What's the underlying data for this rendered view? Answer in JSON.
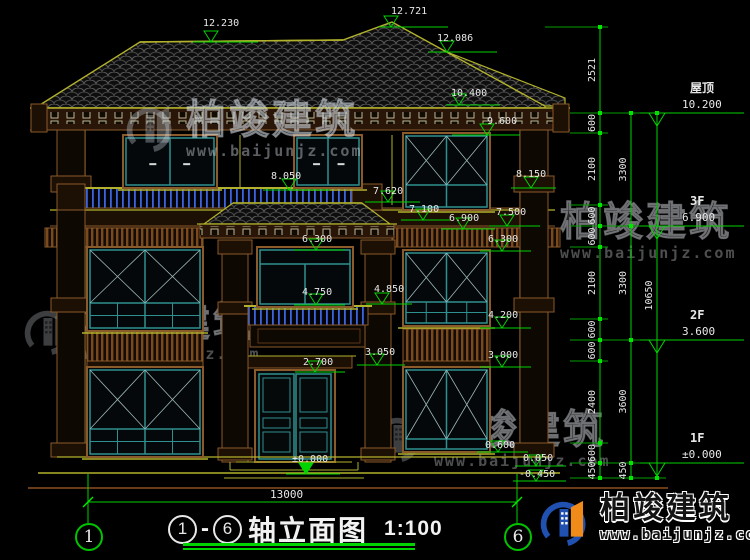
{
  "drawing": {
    "axis_left": "1",
    "axis_right": "6",
    "separator": "-",
    "title_text": "轴立面图",
    "scale": "1:100",
    "overall_dim": "13000"
  },
  "brand": {
    "name": "柏竣建筑",
    "url": "www.baijunjz.com"
  },
  "right_panel": {
    "flags": [
      {
        "name": "屋顶",
        "elev": "10.200",
        "y": 113
      },
      {
        "name": "3F",
        "elev": "6.900",
        "y": 226
      },
      {
        "name": "2F",
        "elev": "3.600",
        "y": 340
      },
      {
        "name": "1F",
        "elev": "±0.000",
        "y": 463
      }
    ],
    "col1": {
      "x": 600,
      "segs": [
        [
          "2521",
          27,
          113
        ],
        [
          "600",
          113,
          133
        ],
        [
          "2100",
          133,
          205
        ],
        [
          "600",
          205,
          226
        ],
        [
          "600",
          226,
          247
        ],
        [
          "2100",
          247,
          319
        ],
        [
          "600",
          319,
          340
        ],
        [
          "600",
          340,
          361
        ],
        [
          "2400",
          361,
          443
        ],
        [
          "600",
          443,
          463
        ],
        [
          "450",
          463,
          478
        ]
      ]
    },
    "col2": {
      "x": 631,
      "segs": [
        [
          "3300",
          113,
          226
        ],
        [
          "3300",
          226,
          340
        ],
        [
          "3600",
          340,
          463
        ],
        [
          "450",
          463,
          478
        ]
      ]
    },
    "col3": {
      "x": 657,
      "segs": [
        [
          "10650",
          113,
          478
        ]
      ]
    }
  },
  "markers": [
    [
      "12.230",
      203,
      26,
      211,
      42,
      193,
      258
    ],
    [
      "12.721",
      391,
      14,
      391,
      27,
      379,
      448
    ],
    [
      "12.086",
      437,
      41,
      447,
      52,
      428,
      497
    ],
    [
      "10.400",
      451,
      96,
      459,
      105,
      446,
      500
    ],
    [
      "9.600",
      487,
      124,
      487,
      135,
      452,
      520
    ],
    [
      "8.050",
      271,
      179,
      289,
      190,
      263,
      330
    ],
    [
      "8.150",
      516,
      177,
      531,
      188,
      511,
      556
    ],
    [
      "7.620",
      373,
      194,
      388,
      202,
      365,
      420
    ],
    [
      "7.500",
      496,
      215,
      507,
      226,
      489,
      540
    ],
    [
      "7.100",
      409,
      212,
      423,
      220,
      401,
      450
    ],
    [
      "6.900",
      449,
      221,
      463,
      229,
      441,
      495
    ],
    [
      "6.300",
      302,
      242,
      316,
      250,
      294,
      345
    ],
    [
      "6.300",
      488,
      242,
      502,
      251,
      480,
      531
    ],
    [
      "4.750",
      302,
      295,
      316,
      305,
      294,
      345
    ],
    [
      "4.850",
      374,
      292,
      382,
      304,
      366,
      412
    ],
    [
      "4.200",
      488,
      318,
      502,
      328,
      480,
      531
    ],
    [
      "3.050",
      365,
      355,
      377,
      365,
      357,
      405
    ],
    [
      "3.000",
      488,
      358,
      502,
      367,
      480,
      531
    ],
    [
      "2.700",
      303,
      365,
      315,
      372,
      295,
      345
    ],
    [
      "±0.000",
      292,
      462,
      306,
      474,
      286,
      340,
      1
    ],
    [
      "0.600",
      485,
      448,
      498,
      452,
      477,
      528
    ],
    [
      "0.050",
      523,
      461,
      536,
      466,
      515,
      566
    ],
    [
      "-0.450",
      519,
      477,
      536,
      481,
      513,
      566
    ]
  ],
  "colors": {
    "background": "#000000",
    "dim_green": "#00d400",
    "wall_yellow": "#b2b22c",
    "trim_brown": "#8a5a2a",
    "window_teal": "#2f9090",
    "rail_blue": "#3c64dc",
    "text_white": "#e8e8e8"
  }
}
